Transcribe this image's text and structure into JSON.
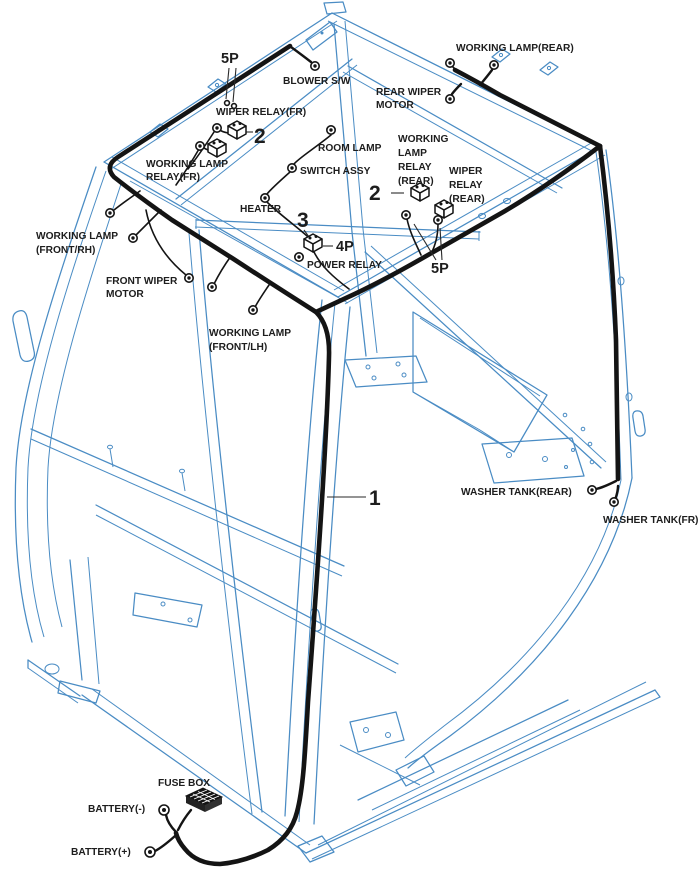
{
  "colors": {
    "background": "#ffffff",
    "frame": "#4a8cc4",
    "frame_light": "#9dc2dd",
    "harness": "#141414",
    "leader": "#2a2a2a",
    "text": "#1d1d1d"
  },
  "callouts": {
    "num1": "1",
    "num2_front": "2",
    "num2_rear": "2",
    "num3": "3",
    "pin4": "4P",
    "pin5_front": "5P",
    "pin5_rear": "5P"
  },
  "labels": {
    "blower_sw": "BLOWER S/W",
    "wiper_relay_fr": "WIPER RELAY(FR)",
    "working_lamp_relay_fr": [
      "WORKING LAMP",
      "RELAY(FR)"
    ],
    "room_lamp": "ROOM LAMP",
    "switch_assy": "SWITCH ASSY",
    "heater": "HEATER",
    "rear_wiper_motor": [
      "REAR WIPER",
      "MOTOR"
    ],
    "working_lamp_rear": "WORKING LAMP(REAR)",
    "working_lamp_relay_rear": [
      "WORKING",
      "LAMP",
      "RELAY",
      "(REAR)"
    ],
    "wiper_relay_rear": [
      "WIPER",
      "RELAY",
      "(REAR)"
    ],
    "power_relay": "POWER RELAY",
    "working_lamp_front_rh": [
      "WORKING LAMP",
      "(FRONT/RH)"
    ],
    "front_wiper_motor": [
      "FRONT WIPER",
      "MOTOR"
    ],
    "working_lamp_front_lh": [
      "WORKING LAMP",
      "(FRONT/LH)"
    ],
    "washer_tank_rear": "WASHER TANK(REAR)",
    "washer_tank_fr": "WASHER TANK(FR)",
    "fuse_box": "FUSE BOX",
    "battery_neg": "BATTERY(-)",
    "battery_pos": "BATTERY(+)"
  }
}
